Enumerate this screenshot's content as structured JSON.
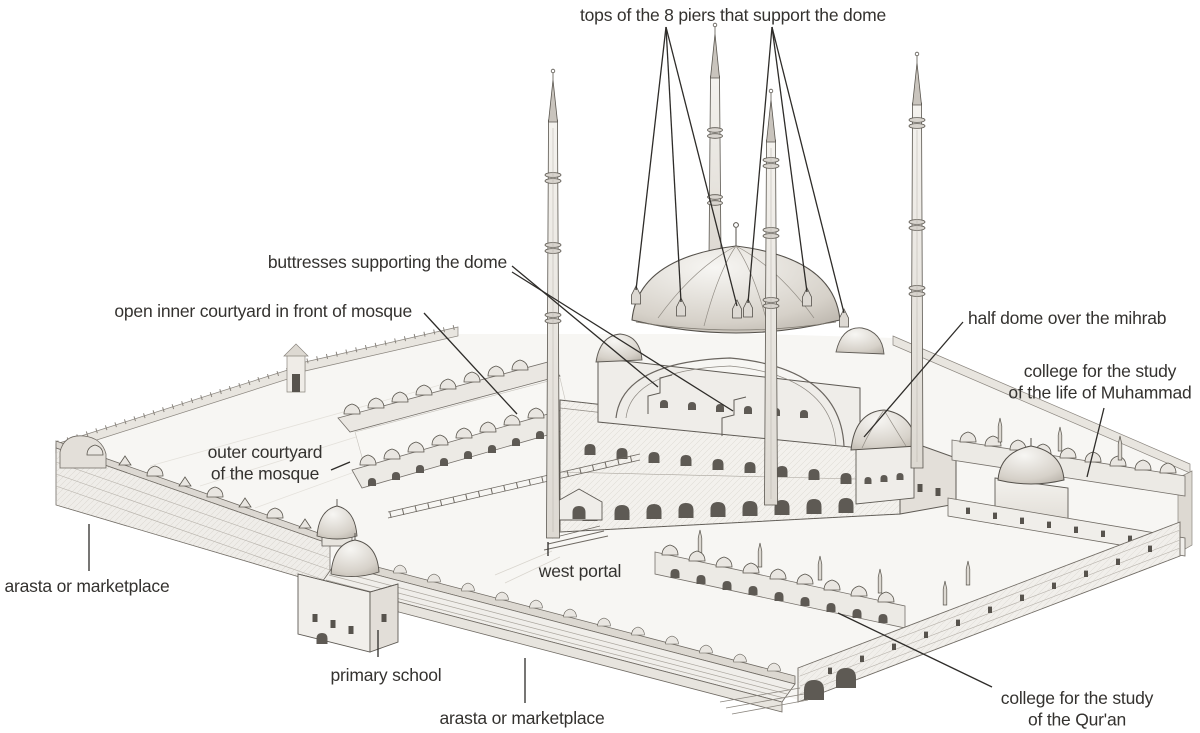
{
  "figure": {
    "kind": "annotated architectural drawing",
    "background": "#ffffff"
  },
  "annotations": {
    "font_size": 17.5,
    "line_height": 21.5,
    "text_color": "#34322f",
    "leader_color": "#2e2c29",
    "labels": [
      {
        "id": "label-piers",
        "lines": [
          "tops of the 8 piers that support the dome"
        ],
        "x": 733,
        "y": 21,
        "anchor": "middle"
      },
      {
        "id": "label-buttresses",
        "lines": [
          "buttresses supporting the dome"
        ],
        "x": 507,
        "y": 268,
        "anchor": "end"
      },
      {
        "id": "label-inner-courtyard",
        "lines": [
          "open inner courtyard in front of mosque"
        ],
        "x": 412,
        "y": 317,
        "anchor": "end"
      },
      {
        "id": "label-half-dome",
        "lines": [
          "half dome over the mihrab"
        ],
        "x": 968,
        "y": 324,
        "anchor": "start"
      },
      {
        "id": "label-college-muhammad",
        "lines": [
          "college for the study",
          "of the life of Muhammad"
        ],
        "x": 1100,
        "y": 377,
        "anchor": "middle"
      },
      {
        "id": "label-outer-courtyard",
        "lines": [
          "outer courtyard",
          "of the mosque"
        ],
        "x": 265,
        "y": 458,
        "anchor": "middle"
      },
      {
        "id": "label-arasta-left",
        "lines": [
          "arasta or marketplace"
        ],
        "x": 87,
        "y": 592,
        "anchor": "middle"
      },
      {
        "id": "label-west-portal",
        "lines": [
          "west portal"
        ],
        "x": 580,
        "y": 577,
        "anchor": "middle"
      },
      {
        "id": "label-primary-school",
        "lines": [
          "primary school"
        ],
        "x": 386,
        "y": 681,
        "anchor": "middle"
      },
      {
        "id": "label-arasta-bottom",
        "lines": [
          "arasta or marketplace"
        ],
        "x": 522,
        "y": 724,
        "anchor": "middle"
      },
      {
        "id": "label-college-quran",
        "lines": [
          "college for the study",
          "of the Qur'an"
        ],
        "x": 1077,
        "y": 704,
        "anchor": "middle"
      }
    ],
    "leader_lines": [
      {
        "x1": 666,
        "y1": 27,
        "x2": 636,
        "y2": 290
      },
      {
        "x1": 666,
        "y1": 27,
        "x2": 681,
        "y2": 302
      },
      {
        "x1": 666,
        "y1": 27,
        "x2": 737,
        "y2": 306
      },
      {
        "x1": 772,
        "y1": 27,
        "x2": 748,
        "y2": 303
      },
      {
        "x1": 772,
        "y1": 27,
        "x2": 807,
        "y2": 292
      },
      {
        "x1": 772,
        "y1": 27,
        "x2": 844,
        "y2": 313
      },
      {
        "x1": 512,
        "y1": 266,
        "x2": 658,
        "y2": 387
      },
      {
        "x1": 512,
        "y1": 272,
        "x2": 733,
        "y2": 411
      },
      {
        "x1": 424,
        "y1": 313,
        "x2": 517,
        "y2": 414
      },
      {
        "x1": 963,
        "y1": 322,
        "x2": 864,
        "y2": 437
      },
      {
        "x1": 1104,
        "y1": 408,
        "x2": 1087,
        "y2": 477
      },
      {
        "x1": 331,
        "y1": 470,
        "x2": 350,
        "y2": 462
      },
      {
        "x1": 89,
        "y1": 524,
        "x2": 89,
        "y2": 571
      },
      {
        "x1": 548,
        "y1": 542,
        "x2": 548,
        "y2": 556
      },
      {
        "x1": 378,
        "y1": 630,
        "x2": 378,
        "y2": 657
      },
      {
        "x1": 525,
        "y1": 658,
        "x2": 525,
        "y2": 703
      },
      {
        "x1": 992,
        "y1": 687,
        "x2": 838,
        "y2": 613
      }
    ]
  }
}
